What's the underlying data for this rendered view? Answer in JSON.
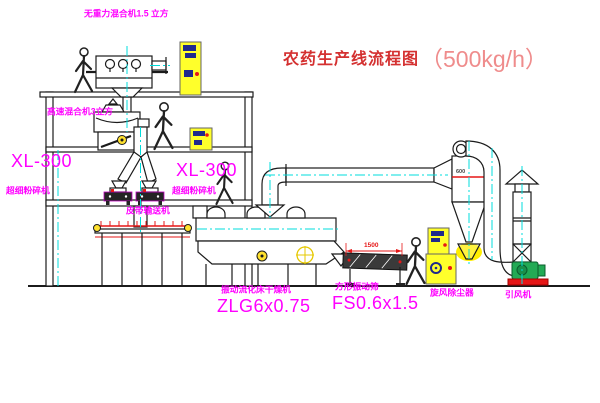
{
  "title": {
    "cn": "农药生产线流程图",
    "capacity": "（500kg/h）"
  },
  "labels": {
    "top_mixer": "无重力混合机1.5 立方",
    "floor2_mixer": "高速混合机3立方",
    "xl_left_model": "XL-300",
    "xl_left_name": "超细粉碎机",
    "xl_mid_model": "XL-300",
    "xl_mid_name": "超细粉碎机",
    "belt": "皮带输送机",
    "dryer_name": "振动流化床干燥机",
    "dryer_model": "ZLG6x0.75",
    "sieve_name": "方形振动筛",
    "sieve_model": "FS0.6x1.5",
    "cyclone": "旋风除尘器",
    "fan": "引风机",
    "dimension": "1500",
    "cyclone_marking": "600"
  },
  "colors": {
    "label_magenta": "#ff00ff",
    "title_red": "#d43030",
    "capacity_red": "#ef8c8c",
    "centerline_cyan": "#00dcdc",
    "cabinet_yellow": "#ffff2b",
    "accent_red": "#e61717",
    "fan_green": "#22aa55",
    "line_black": "#1b1b1b"
  }
}
